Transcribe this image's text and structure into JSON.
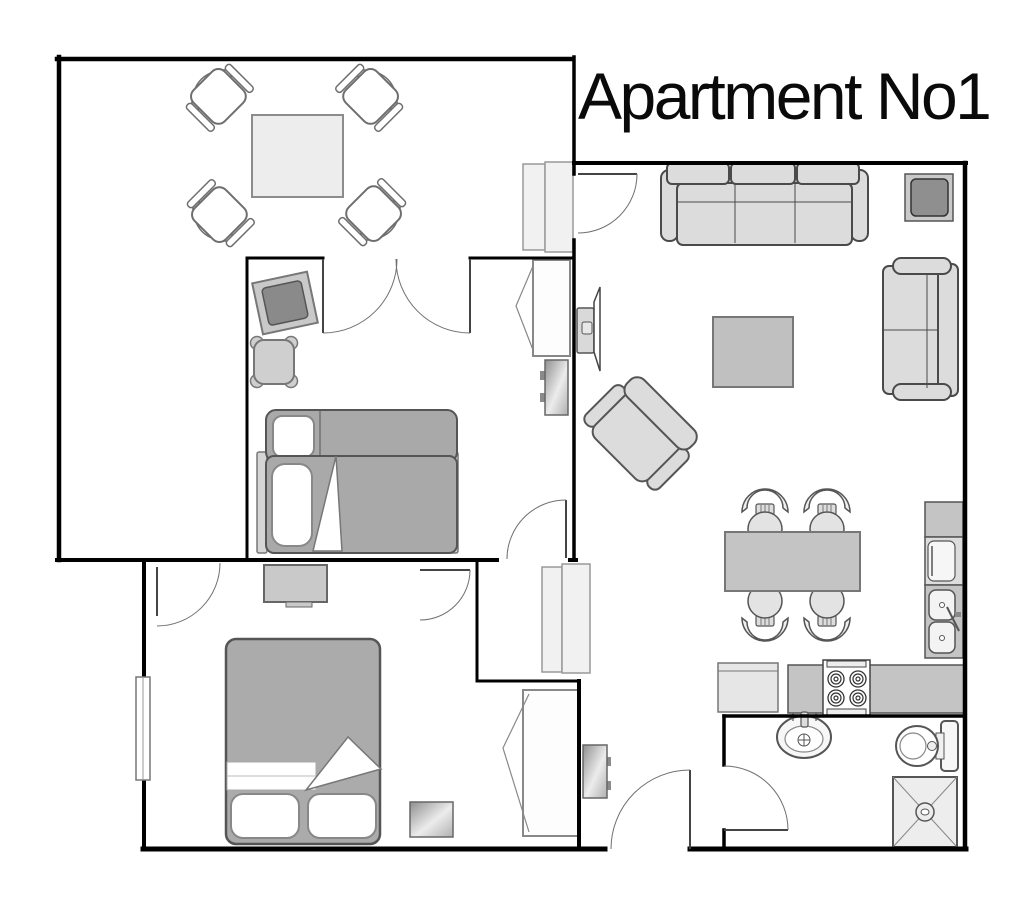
{
  "title": "Apartment No1",
  "canvas": {
    "width": 1021,
    "height": 907,
    "background": "#ffffff"
  },
  "palette": {
    "wall": "#000000",
    "door_line": "#444444",
    "arc_line": "#707070",
    "sofa_fill": "#dcdcdc",
    "bed_fill": "#ababab",
    "table_light": "#ededed",
    "table_mid": "#c4c4c4",
    "counter": "#c4c4c4",
    "cabinet": "#c9c9c9",
    "closet_fill": "#f1f1f1",
    "screen_dark": "#8a8a8a",
    "fixture_white": "#ffffff",
    "metal_gradient": [
      "#9a9a9a",
      "#ececec",
      "#b5b5b5"
    ]
  },
  "rooms": [
    {
      "id": "dining-room",
      "items": [
        "dining-table",
        "armchair-top-left",
        "armchair-top-right",
        "armchair-bottom-left",
        "armchair-bottom-right",
        "closet-by-door"
      ]
    },
    {
      "id": "bedroom-middle",
      "items": [
        "double-doors",
        "tilted-tv",
        "ottoman",
        "wardrobe",
        "wall-tv",
        "sofa-bed",
        "door"
      ]
    },
    {
      "id": "bedroom-bottom",
      "items": [
        "door-from-dining",
        "door-from-hall",
        "dresser",
        "window",
        "double-bed",
        "media-stand",
        "wardrobe"
      ]
    },
    {
      "id": "living-room",
      "items": [
        "entry-door-from-dining",
        "sofa-3-seat",
        "corner-tv",
        "loveseat",
        "coffee-table",
        "armchair",
        "wall-tv",
        "dining-table",
        "chair-1",
        "chair-2",
        "chair-3",
        "chair-4"
      ]
    },
    {
      "id": "kitchen",
      "items": [
        "upper-cabinet",
        "dishwasher",
        "double-sink",
        "counter",
        "stove",
        "refrigerator"
      ]
    },
    {
      "id": "hallway",
      "items": [
        "closet-1",
        "closet-2",
        "wall-screen"
      ]
    },
    {
      "id": "entry",
      "items": [
        "entrance-door"
      ]
    },
    {
      "id": "bathroom",
      "items": [
        "door",
        "washbasin",
        "toilet",
        "shower"
      ]
    }
  ]
}
